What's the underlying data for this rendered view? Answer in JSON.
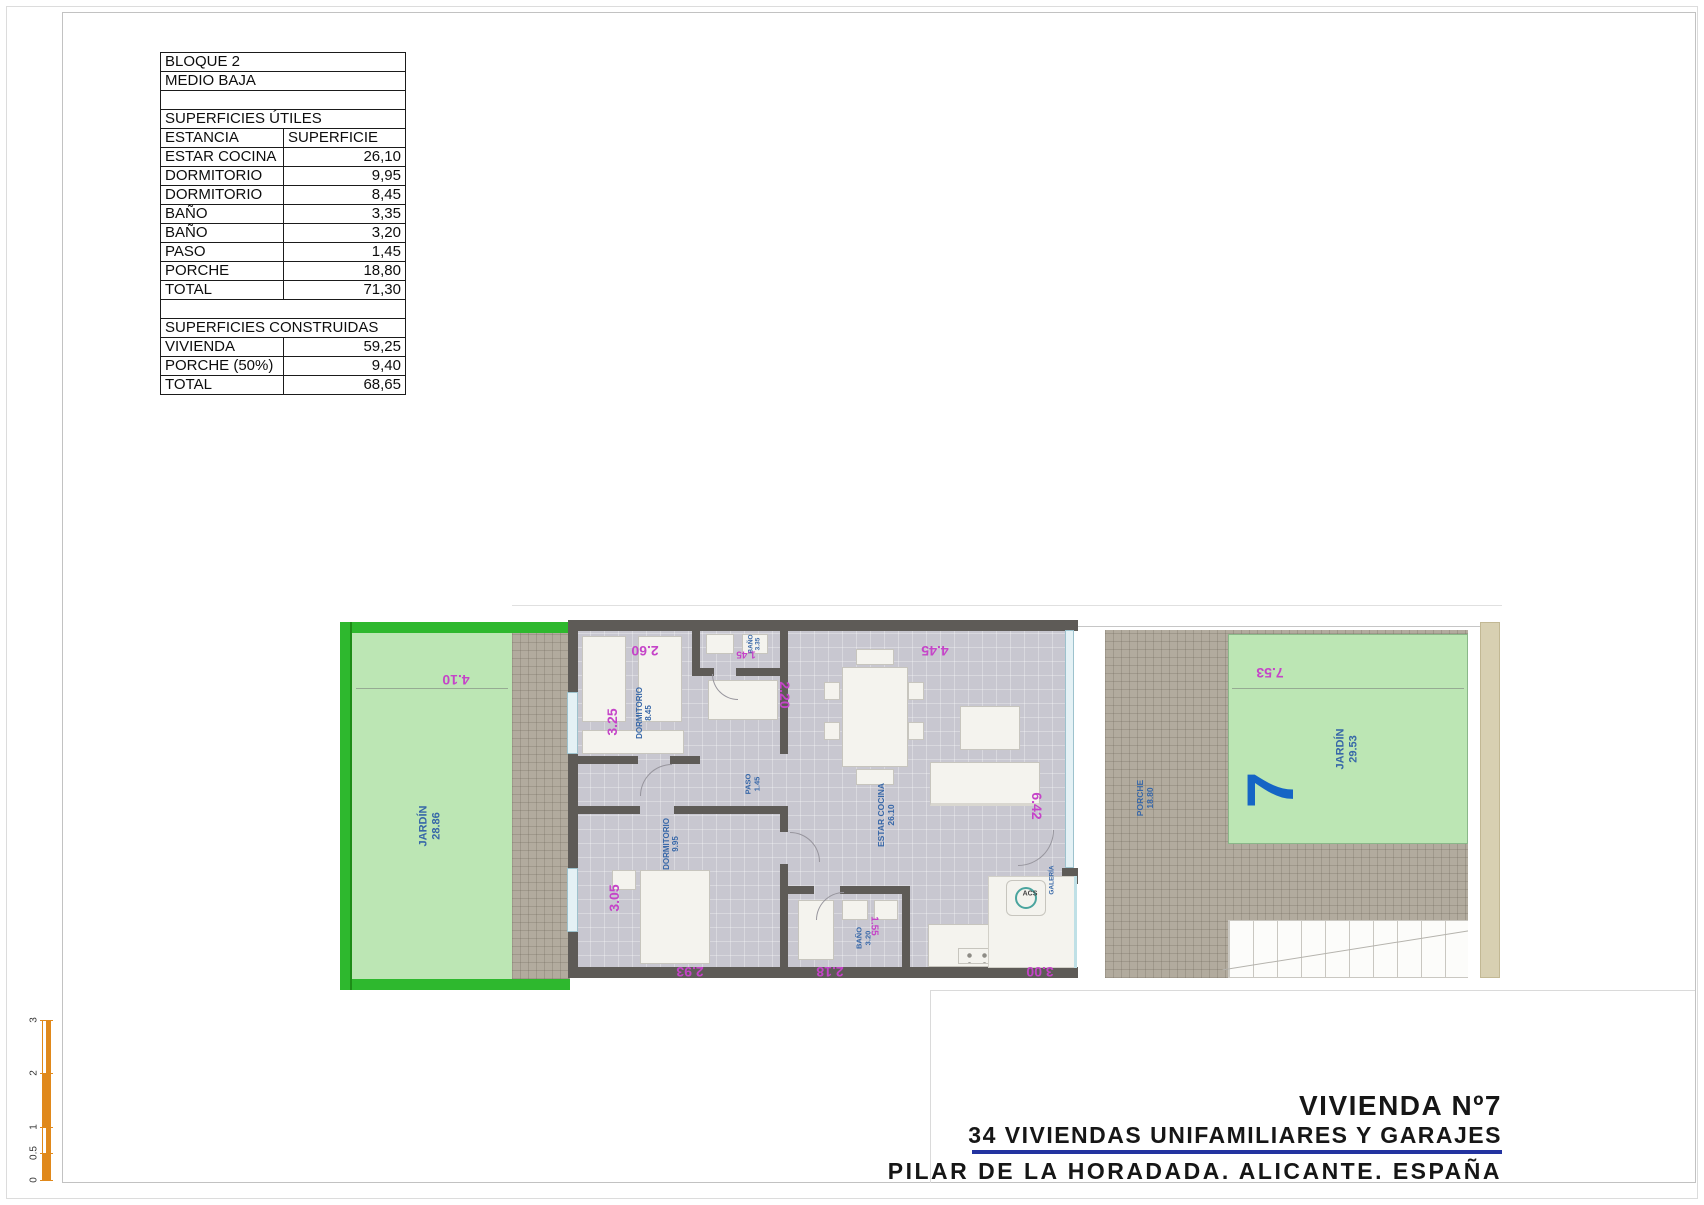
{
  "area_table": {
    "rows": [
      {
        "label": "BLOQUE 2"
      },
      {
        "label": "MEDIO BAJA"
      },
      {
        "label": ""
      },
      {
        "label": "SUPERFICIES ÚTILES"
      },
      {
        "label": "ESTANCIA",
        "value": "SUPERFICIE"
      },
      {
        "label": "ESTAR COCINA",
        "value": "26,10"
      },
      {
        "label": "DORMITORIO",
        "value": "9,95"
      },
      {
        "label": "DORMITORIO",
        "value": "8,45"
      },
      {
        "label": "BAÑO",
        "value": "3,35"
      },
      {
        "label": "BAÑO",
        "value": "3,20"
      },
      {
        "label": "PASO",
        "value": "1,45"
      },
      {
        "label": "PORCHE",
        "value": "18,80"
      },
      {
        "label": "TOTAL",
        "value": "71,30"
      },
      {
        "label": ""
      },
      {
        "label": "SUPERFICIES CONSTRUIDAS"
      },
      {
        "label": "VIVIENDA",
        "value": "59,25"
      },
      {
        "label": "PORCHE (50%)",
        "value": "9,40"
      },
      {
        "label": "TOTAL",
        "value": "68,65"
      }
    ]
  },
  "floor_plan": {
    "rooms": {
      "jardin_left": {
        "name": "JARDÍN",
        "area": "28.86"
      },
      "dormitorio_1": {
        "name": "DORMITORIO",
        "area": "8.45"
      },
      "bano_1": {
        "name": "BAÑO",
        "area": "3.35"
      },
      "paso": {
        "name": "PASO",
        "area": "1.45"
      },
      "dormitorio_2": {
        "name": "DORMITORIO",
        "area": "9.95"
      },
      "bano_2": {
        "name": "BAÑO",
        "area": "3.20"
      },
      "estar_cocina": {
        "name": "ESTAR COCINA",
        "area": "26.10"
      },
      "porche": {
        "name": "PORCHE",
        "area": "18.80"
      },
      "galeria": {
        "name": "GALERÍA"
      },
      "jardin_right": {
        "name": "JARDÍN",
        "area": "29.53"
      }
    },
    "unit_number": "7",
    "acs_label": "ACS",
    "dimensions": {
      "jardin_left_width": "4.10",
      "dorm1_width": "2.60",
      "dorm1_depth": "3.25",
      "bano1_width": "1.45",
      "closet_depth": "2.20",
      "living_width": "4.45",
      "living_depth": "6.42",
      "dorm2_depth": "3.05",
      "dorm2_width": "2.93",
      "bano2_width": "2.18",
      "bano2_depth": "1.55",
      "kitchen_width": "3.00",
      "jardin_right_width": "7.53"
    }
  },
  "scale_bar": {
    "ticks": [
      "0",
      "0.5",
      "1",
      "2",
      "3"
    ]
  },
  "title_block": {
    "line1": "VIVIENDA Nº7",
    "line2": "34 VIVIENDAS UNIFAMILIARES Y GARAJES",
    "line3": "PILAR DE LA HORADADA. ALICANTE. ESPAÑA"
  },
  "colors": {
    "wall": "#5e5b57",
    "floor": "#c8c7d0",
    "tile": "#b2ab9e",
    "garden_frame": "#2eb82e",
    "garden_fill": "#bce6b4",
    "label_blue": "#3767a8",
    "dimension_magenta": "#c544c8",
    "unit_number_blue": "#1565c5",
    "scale_orange": "#e0891c",
    "title_rule_navy": "#2333a0"
  }
}
